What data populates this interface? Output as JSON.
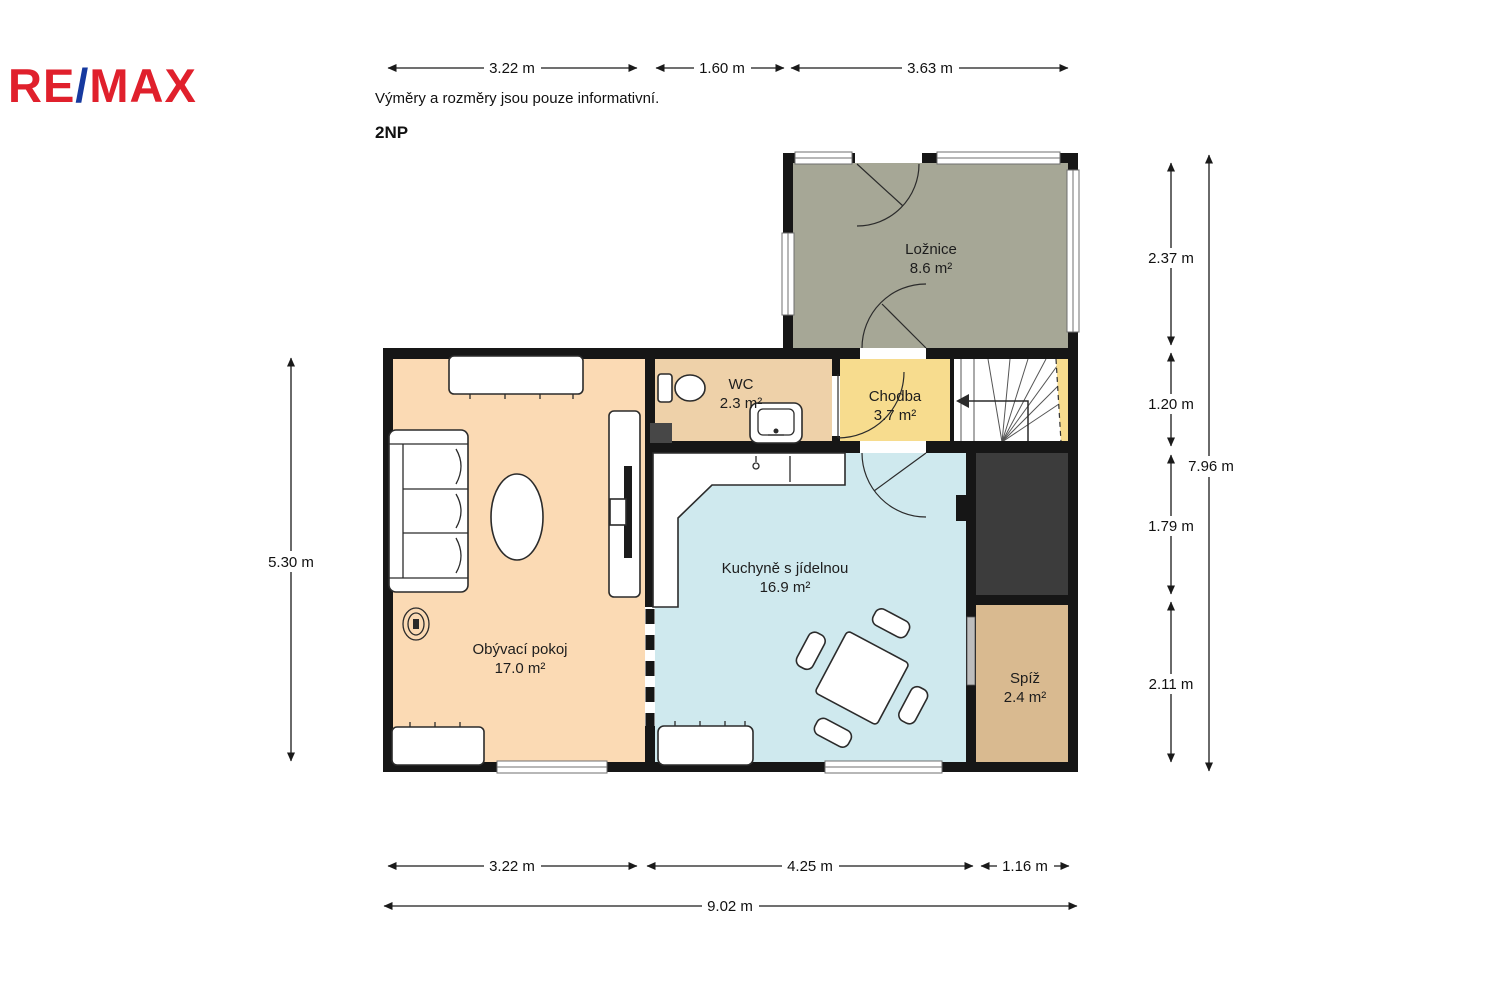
{
  "header": {
    "logo_part1": "RE",
    "logo_slash": "/",
    "logo_part2": "MAX",
    "logo_red": "#e0202c",
    "logo_blue": "#16399f",
    "disclaimer": "Výměry a rozměry jsou pouze informativní.",
    "floor_label": "2NP"
  },
  "rooms": {
    "loznice": {
      "name": "Ložnice",
      "area": "8.6 m²",
      "color": "#a6a796"
    },
    "wc": {
      "name": "WC",
      "area": "2.3 m²",
      "color": "#eed1a9"
    },
    "chodba": {
      "name": "Chodba",
      "area": "3.7 m²",
      "color": "#f7dc8e"
    },
    "kuchyne": {
      "name": "Kuchyně s jídelnou",
      "area": "16.9 m²",
      "color": "#cfe9ee"
    },
    "obyvaci": {
      "name": "Obývací pokoj",
      "area": "17.0 m²",
      "color": "#fbdab4"
    },
    "spiz": {
      "name": "Spíž",
      "area": "2.4 m²",
      "color": "#d9ba90"
    }
  },
  "dimensions": {
    "top": [
      "3.22 m",
      "1.60 m",
      "3.63 m"
    ],
    "bottom": [
      "3.22 m",
      "4.25 m",
      "1.16 m"
    ],
    "bottom_total": "9.02 m",
    "left": "5.30 m",
    "right": [
      "2.37 m",
      "1.20 m",
      "1.79 m",
      "2.11 m"
    ],
    "right_total": "7.96 m"
  },
  "colors": {
    "wall": "#161616",
    "void_space": "#3c3c3c",
    "stairs_fill": "#ffffff",
    "sliding_door": "#bdbdbd"
  }
}
